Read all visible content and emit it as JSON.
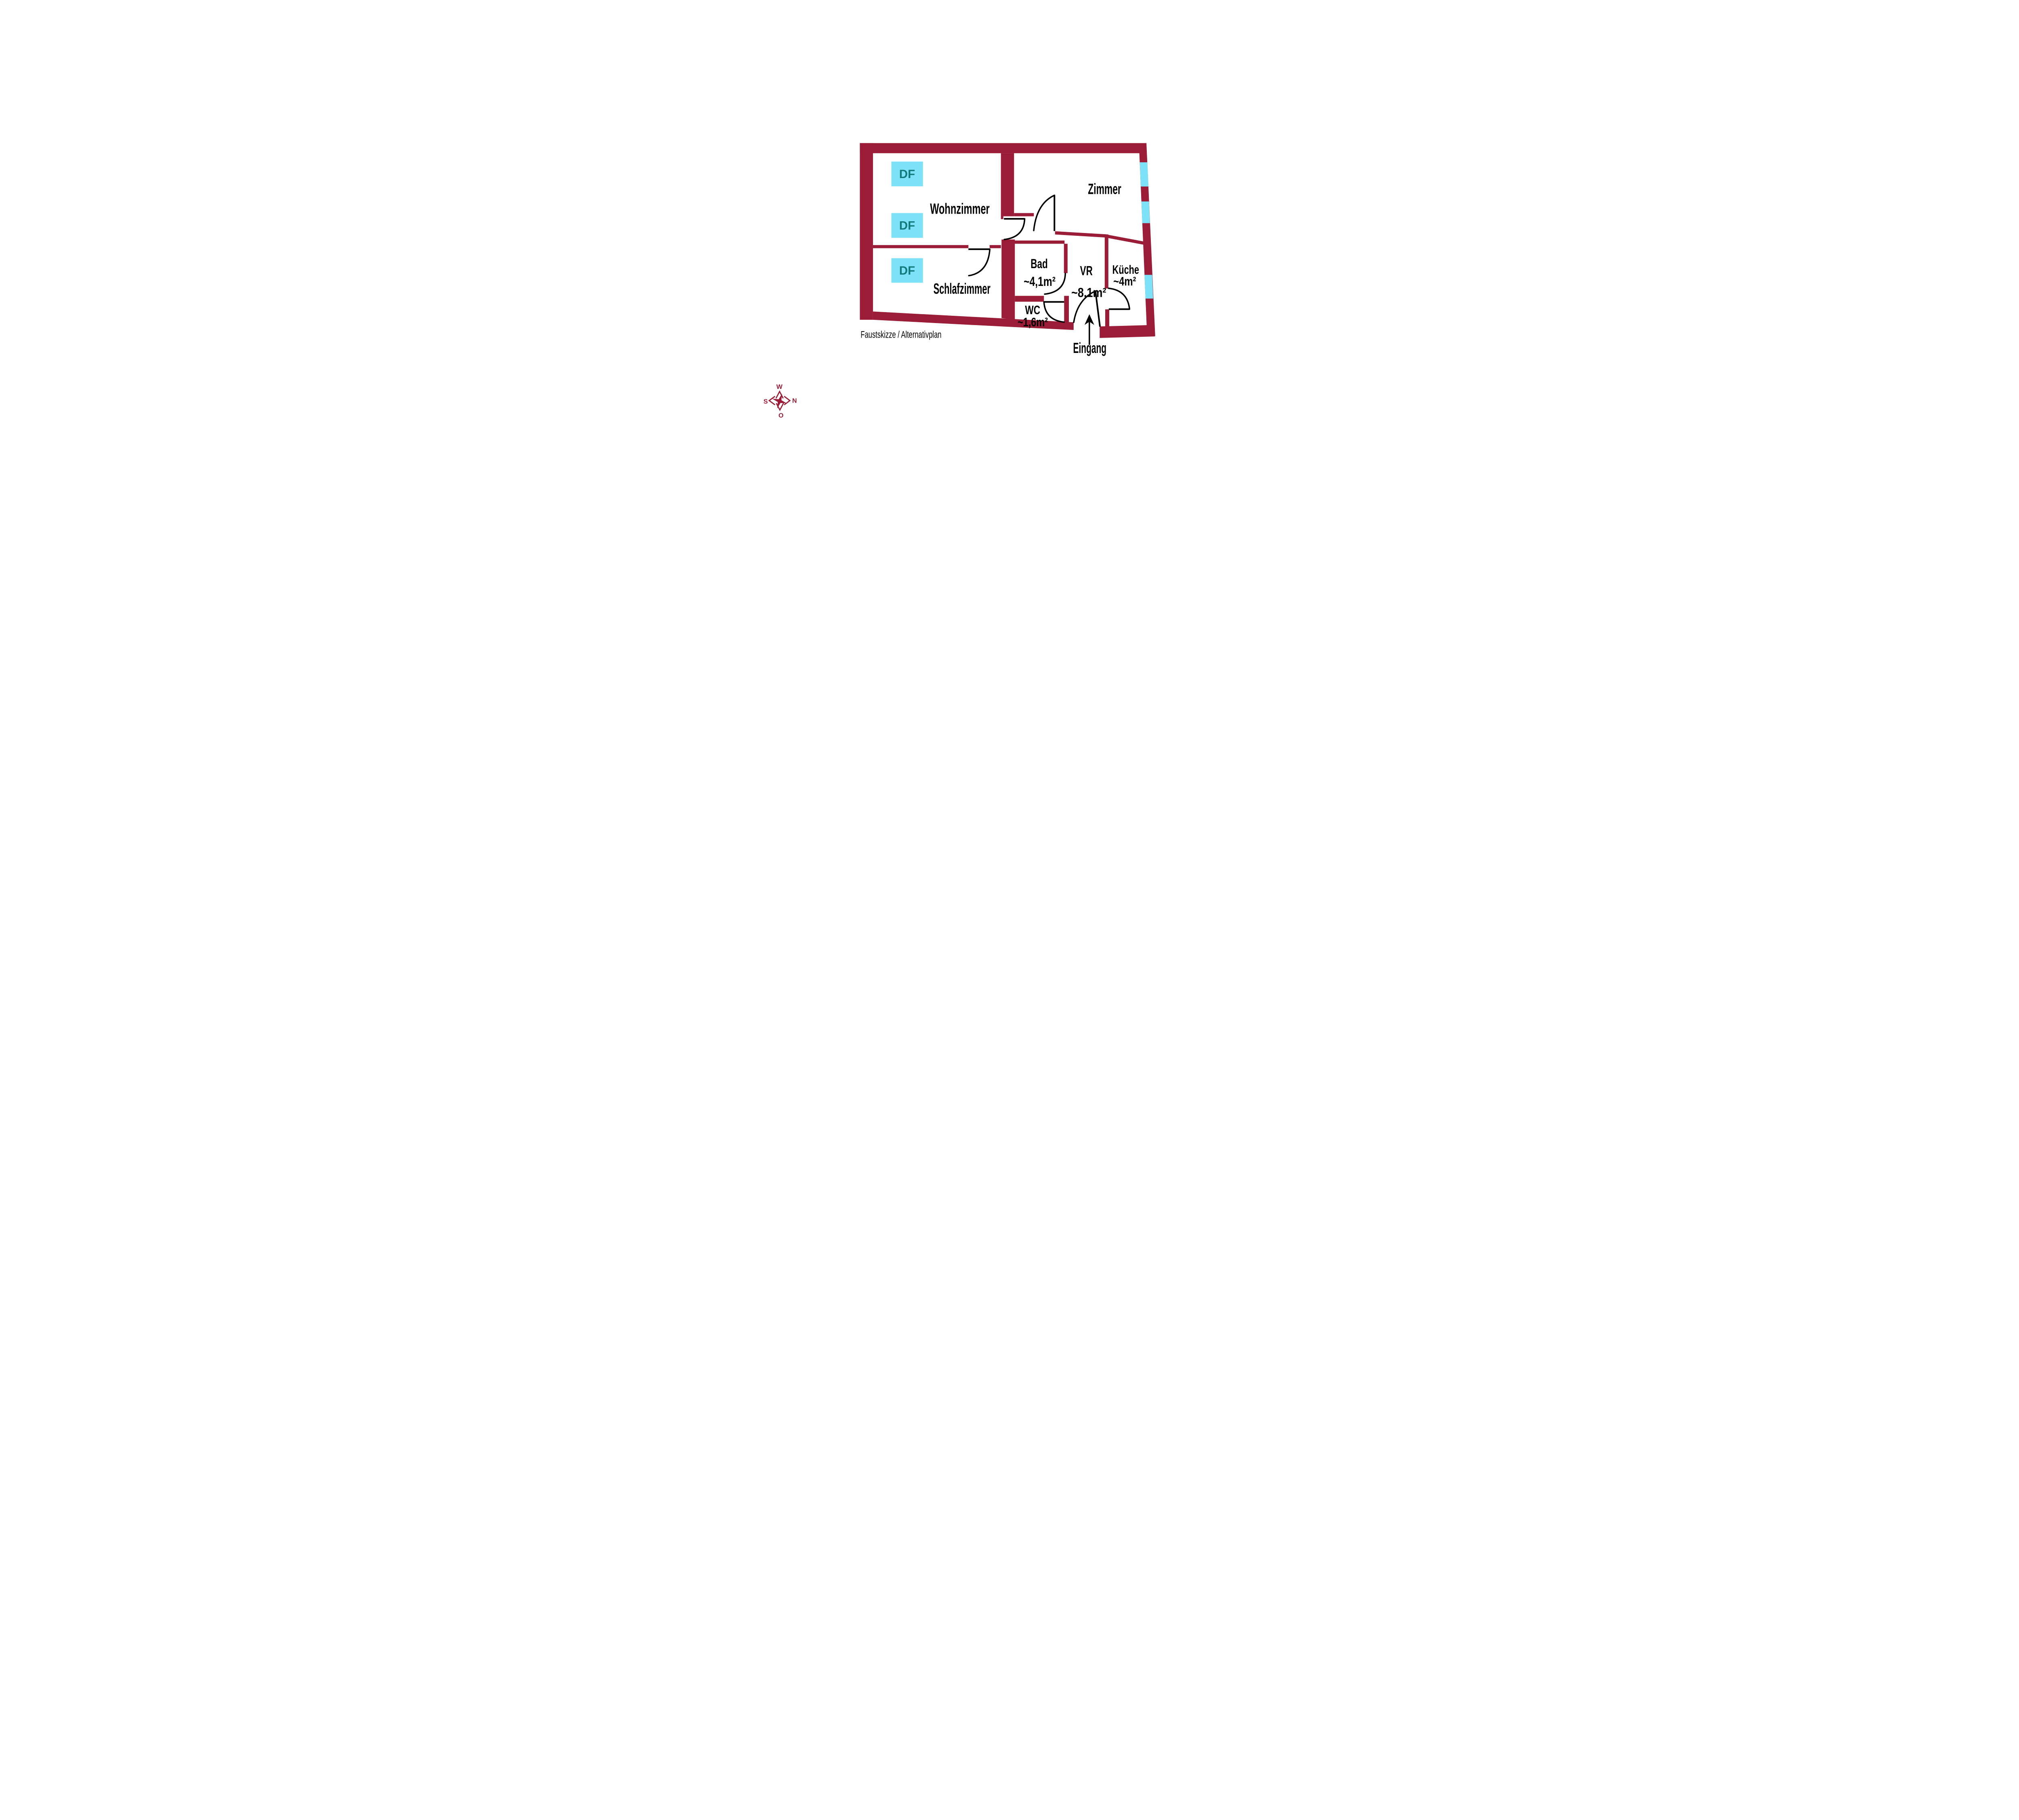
{
  "plan": {
    "caption": "Faustskizze / Alternativplan",
    "rooms": [
      {
        "name": "wohnzimmer",
        "label": "Wohnzimmer",
        "area": ""
      },
      {
        "name": "zimmer",
        "label": "Zimmer",
        "area": ""
      },
      {
        "name": "schlafzimmer",
        "label": "Schlafzimmer",
        "area": ""
      },
      {
        "name": "bad",
        "label": "Bad",
        "area": "~4,1m²"
      },
      {
        "name": "vr",
        "label": "VR",
        "area": "~8,1m²"
      },
      {
        "name": "kueche",
        "label": "Küche",
        "area": "~4m²"
      },
      {
        "name": "wc",
        "label": "WC",
        "area": "~1,6m²"
      }
    ],
    "entrance_label": "Eingang",
    "roof_windows": [
      "DF",
      "DF",
      "DF"
    ],
    "compass": {
      "top": "W",
      "right": "N",
      "left": "S",
      "bottom": "O"
    },
    "colors": {
      "wall": "#9A1C36",
      "window": "#7DE2F8",
      "df_fill": "#7DE2F8",
      "df_text": "#12797B",
      "label": "#000000",
      "compass": "#9A1C36"
    }
  }
}
